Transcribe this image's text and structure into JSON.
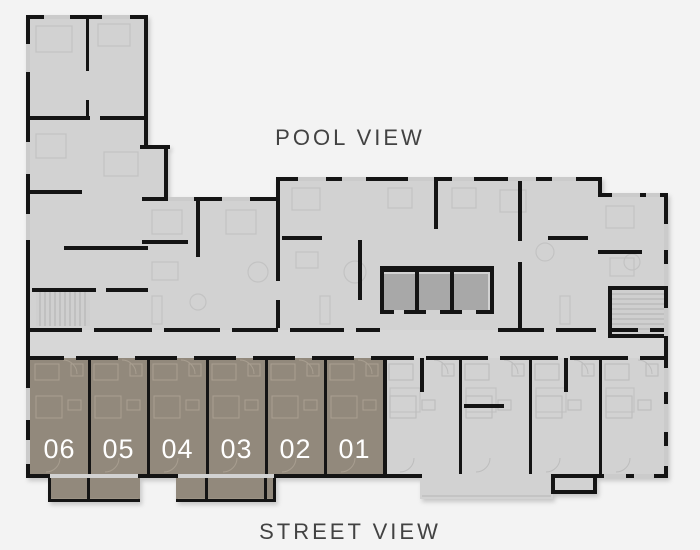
{
  "labels": {
    "pool": "POOL VIEW",
    "street": "STREET VIEW"
  },
  "colors": {
    "background": "#f3f3f3",
    "floor": "#d2d2d2",
    "corridor": "#d7d7d7",
    "wall": "#141414",
    "window": "#cbcbcb",
    "core": "#a8a8a8",
    "stair_tread": "#b0b0b0",
    "highlight": "#92897c",
    "highlight_line": "#a89e90",
    "gray_line": "#c3c3c3",
    "rail": "#b5b5b5",
    "unit_text": "#ffffff",
    "label_text": "#424242"
  },
  "units": [
    {
      "label": "06",
      "x": 30,
      "w": 59
    },
    {
      "label": "05",
      "x": 89,
      "w": 59
    },
    {
      "label": "04",
      "x": 148,
      "w": 59
    },
    {
      "label": "03",
      "x": 207,
      "w": 59
    },
    {
      "label": "02",
      "x": 266,
      "w": 59
    },
    {
      "label": "01",
      "x": 325,
      "w": 59
    }
  ],
  "unit_row": {
    "y": 358,
    "h": 116,
    "number_y": 458,
    "number_size": 27
  },
  "gray_units": [
    {
      "x": 384,
      "w": 76
    },
    {
      "x": 460,
      "w": 70
    },
    {
      "x": 530,
      "w": 70
    },
    {
      "x": 600,
      "w": 64
    }
  ],
  "plan": {
    "slabs": [
      [
        26,
        15,
        122,
        463
      ],
      [
        140,
        145,
        28,
        52
      ],
      [
        142,
        197,
        138,
        281
      ],
      [
        276,
        177,
        324,
        301
      ],
      [
        598,
        193,
        70,
        285
      ]
    ],
    "corridor": [
      30,
      330,
      634,
      28
    ],
    "balconies": [
      {
        "x": 48,
        "y": 478,
        "w": 92,
        "h": 24,
        "kind": "highlight"
      },
      {
        "x": 176,
        "y": 478,
        "w": 100,
        "h": 24,
        "kind": "highlight"
      },
      {
        "x": 420,
        "y": 478,
        "w": 133,
        "h": 21,
        "kind": "floor"
      },
      {
        "x": 553,
        "y": 478,
        "w": 43,
        "h": 16,
        "kind": "floor"
      }
    ],
    "cores": [
      [
        384,
        274,
        31,
        36
      ],
      [
        419,
        274,
        31,
        36
      ],
      [
        454,
        274,
        34,
        36
      ]
    ],
    "stairs": [
      {
        "x": 36,
        "y": 292,
        "w": 54,
        "h": 34,
        "dir": "v"
      },
      {
        "x": 612,
        "y": 290,
        "w": 52,
        "h": 44,
        "dir": "h"
      }
    ],
    "walls": [
      [
        26,
        15,
        4,
        463
      ],
      [
        26,
        15,
        122,
        4
      ],
      [
        144,
        15,
        4,
        132
      ],
      [
        140,
        145,
        30,
        4
      ],
      [
        164,
        145,
        4,
        54
      ],
      [
        142,
        197,
        138,
        4
      ],
      [
        276,
        177,
        4,
        24
      ],
      [
        276,
        177,
        326,
        4
      ],
      [
        598,
        177,
        4,
        20
      ],
      [
        598,
        193,
        70,
        4
      ],
      [
        664,
        193,
        4,
        285
      ],
      [
        26,
        474,
        24,
        4
      ],
      [
        138,
        474,
        40,
        4
      ],
      [
        274,
        474,
        148,
        4
      ],
      [
        551,
        474,
        117,
        4
      ],
      [
        26,
        328,
        56,
        4
      ],
      [
        94,
        328,
        58,
        4
      ],
      [
        164,
        328,
        56,
        4
      ],
      [
        232,
        328,
        46,
        4
      ],
      [
        290,
        328,
        54,
        4
      ],
      [
        356,
        328,
        24,
        4
      ],
      [
        498,
        328,
        46,
        4
      ],
      [
        556,
        328,
        40,
        4
      ],
      [
        608,
        328,
        30,
        4
      ],
      [
        650,
        328,
        14,
        4
      ],
      [
        26,
        356,
        38,
        4
      ],
      [
        76,
        356,
        42,
        4
      ],
      [
        135,
        356,
        42,
        4
      ],
      [
        194,
        356,
        42,
        4
      ],
      [
        253,
        356,
        42,
        4
      ],
      [
        312,
        356,
        42,
        4
      ],
      [
        371,
        356,
        15,
        4
      ],
      [
        386,
        356,
        28,
        4
      ],
      [
        426,
        356,
        62,
        4
      ],
      [
        500,
        356,
        58,
        4
      ],
      [
        570,
        356,
        58,
        4
      ],
      [
        640,
        356,
        24,
        4
      ],
      [
        88,
        358,
        3,
        116
      ],
      [
        147,
        358,
        3,
        116
      ],
      [
        206,
        358,
        3,
        116
      ],
      [
        265,
        358,
        3,
        116
      ],
      [
        324,
        358,
        3,
        116
      ],
      [
        383,
        358,
        4,
        116
      ],
      [
        459,
        358,
        3,
        116
      ],
      [
        529,
        358,
        3,
        116
      ],
      [
        599,
        358,
        3,
        116
      ],
      [
        48,
        478,
        3,
        24
      ],
      [
        48,
        499,
        92,
        3
      ],
      [
        87,
        478,
        3,
        21
      ],
      [
        273,
        478,
        3,
        24
      ],
      [
        176,
        499,
        100,
        3
      ],
      [
        205,
        478,
        3,
        21
      ],
      [
        264,
        478,
        3,
        21
      ],
      [
        551,
        478,
        4,
        16
      ],
      [
        551,
        490,
        46,
        4
      ],
      [
        593,
        478,
        4,
        16
      ],
      [
        380,
        266,
        114,
        6
      ],
      [
        380,
        272,
        4,
        40
      ],
      [
        490,
        272,
        4,
        40
      ],
      [
        415,
        272,
        4,
        38
      ],
      [
        450,
        272,
        4,
        38
      ],
      [
        380,
        310,
        14,
        4
      ],
      [
        404,
        310,
        22,
        4
      ],
      [
        440,
        310,
        22,
        4
      ],
      [
        476,
        310,
        18,
        4
      ],
      [
        86,
        15,
        3,
        56
      ],
      [
        86,
        100,
        3,
        18
      ],
      [
        276,
        201,
        4,
        80
      ],
      [
        276,
        300,
        4,
        28
      ],
      [
        358,
        240,
        4,
        60
      ],
      [
        434,
        177,
        4,
        52
      ],
      [
        518,
        177,
        4,
        64
      ],
      [
        518,
        262,
        4,
        66
      ],
      [
        26,
        116,
        64,
        4
      ],
      [
        100,
        116,
        48,
        4
      ],
      [
        26,
        190,
        56,
        4
      ],
      [
        64,
        246,
        84,
        4
      ],
      [
        32,
        288,
        64,
        4
      ],
      [
        106,
        288,
        42,
        4
      ],
      [
        142,
        240,
        46,
        4
      ],
      [
        196,
        201,
        4,
        56
      ],
      [
        282,
        236,
        40,
        4
      ],
      [
        548,
        236,
        40,
        4
      ],
      [
        598,
        250,
        44,
        4
      ],
      [
        608,
        286,
        4,
        52
      ],
      [
        608,
        286,
        56,
        4
      ],
      [
        608,
        334,
        60,
        4
      ],
      [
        420,
        358,
        4,
        34
      ],
      [
        464,
        404,
        40,
        4
      ],
      [
        564,
        358,
        4,
        34
      ]
    ],
    "windows": [
      [
        44,
        15,
        26,
        4
      ],
      [
        102,
        15,
        28,
        4
      ],
      [
        26,
        44,
        4,
        28
      ],
      [
        26,
        142,
        4,
        32
      ],
      [
        26,
        214,
        4,
        26
      ],
      [
        26,
        388,
        4,
        32
      ],
      [
        26,
        440,
        4,
        24
      ],
      [
        168,
        197,
        26,
        4
      ],
      [
        222,
        197,
        28,
        4
      ],
      [
        298,
        177,
        28,
        4
      ],
      [
        342,
        177,
        24,
        4
      ],
      [
        408,
        177,
        26,
        4
      ],
      [
        452,
        177,
        22,
        4
      ],
      [
        508,
        177,
        28,
        4
      ],
      [
        552,
        177,
        24,
        4
      ],
      [
        612,
        193,
        28,
        4
      ],
      [
        646,
        193,
        14,
        4
      ],
      [
        664,
        224,
        4,
        26
      ],
      [
        664,
        264,
        4,
        22
      ],
      [
        664,
        308,
        4,
        28
      ],
      [
        664,
        368,
        4,
        24
      ],
      [
        664,
        404,
        4,
        28
      ],
      [
        664,
        446,
        4,
        20
      ],
      [
        604,
        474,
        22,
        4
      ],
      [
        634,
        474,
        20,
        4
      ]
    ],
    "furniture_rects": [
      [
        36,
        26,
        36,
        26
      ],
      [
        98,
        24,
        32,
        22
      ],
      [
        36,
        134,
        30,
        24
      ],
      [
        104,
        152,
        34,
        24
      ],
      [
        152,
        210,
        30,
        24
      ],
      [
        226,
        210,
        30,
        24
      ],
      [
        152,
        262,
        26,
        18
      ],
      [
        292,
        188,
        28,
        22
      ],
      [
        296,
        252,
        22,
        16
      ],
      [
        388,
        188,
        24,
        20
      ],
      [
        452,
        188,
        24,
        20
      ],
      [
        500,
        190,
        26,
        22
      ],
      [
        606,
        206,
        28,
        22
      ],
      [
        610,
        258,
        24,
        18
      ],
      [
        390,
        388,
        30,
        24
      ],
      [
        466,
        388,
        30,
        24
      ],
      [
        536,
        388,
        30,
        24
      ],
      [
        606,
        388,
        28,
        24
      ],
      [
        320,
        296,
        10,
        28
      ],
      [
        560,
        296,
        10,
        28
      ],
      [
        152,
        296,
        10,
        28
      ]
    ],
    "furniture_circles": [
      [
        258,
        272,
        10
      ],
      [
        355,
        272,
        11
      ],
      [
        545,
        252,
        9
      ],
      [
        198,
        302,
        8
      ],
      [
        632,
        262,
        8
      ]
    ]
  }
}
